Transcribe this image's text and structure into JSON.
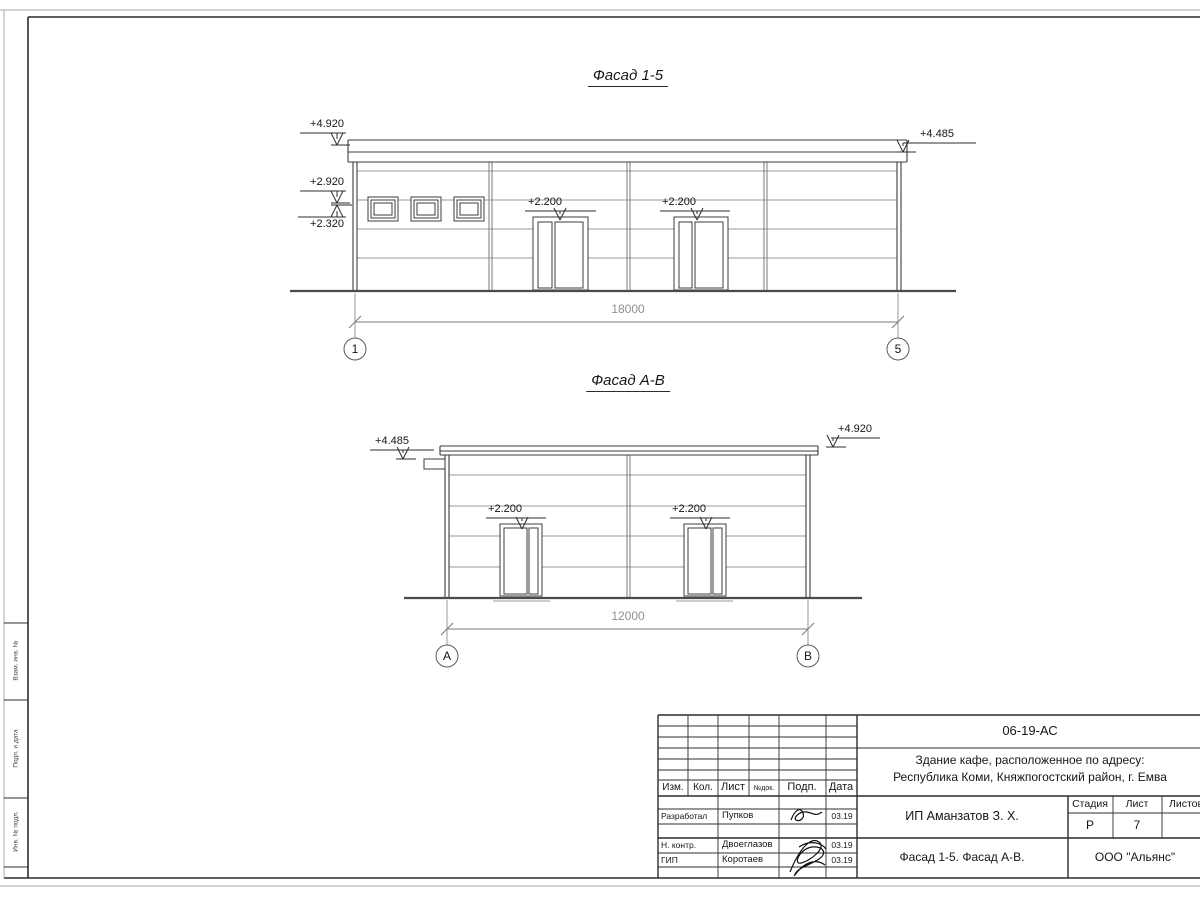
{
  "sheet": {
    "background": "#ffffff",
    "line_color": "#3c3c3c",
    "light_line_color": "#9a9a9a",
    "dim_text_color": "#8f8f8f"
  },
  "facade1": {
    "title": "Фасад 1-5",
    "marks": {
      "m4920": "+4.920",
      "m2920": "+2.920",
      "m2320": "+2.320",
      "m4485": "+4.485",
      "door1": "+2.200",
      "door2": "+2.200"
    },
    "dimension": "18000",
    "axis_left": "1",
    "axis_right": "5"
  },
  "facade2": {
    "title": "Фасад А-В",
    "marks": {
      "m4485": "+4.485",
      "m4920": "+4.920",
      "door1": "+2.200",
      "door2": "+2.200"
    },
    "dimension": "12000",
    "axis_left": "А",
    "axis_right": "В"
  },
  "titleblock": {
    "code": "06-19-АС",
    "address_line1": "Здание кафе, расположенное по адресу:",
    "address_line2": "Республика Коми, Княжпогостский район, г. Емва",
    "col_izm": "Изм.",
    "col_kol": "Кол.",
    "col_list": "Лист",
    "col_ndok": "№док.",
    "col_podp": "Подп.",
    "col_data": "Дата",
    "rows": [
      {
        "role": "Разработал",
        "name": "Пупков",
        "date": "03.19"
      },
      {
        "role": "Н. контр.",
        "name": "Двоеглазов",
        "date": "03.19"
      },
      {
        "role": "ГИП",
        "name": "Коротаев",
        "date": "03.19"
      }
    ],
    "client": "ИП Аманзатов З. Х.",
    "stage_label": "Стадия",
    "sheet_label": "Лист",
    "sheets_label": "Листов",
    "stage": "Р",
    "sheet_number": "7",
    "doc_title": "Фасад 1-5. Фасад А-В.",
    "company": "ООО \"Альянс\""
  },
  "frame": {
    "side_labels": [
      "Взам. инв. №",
      "Подп. и дата",
      "Инв. № подл."
    ]
  }
}
